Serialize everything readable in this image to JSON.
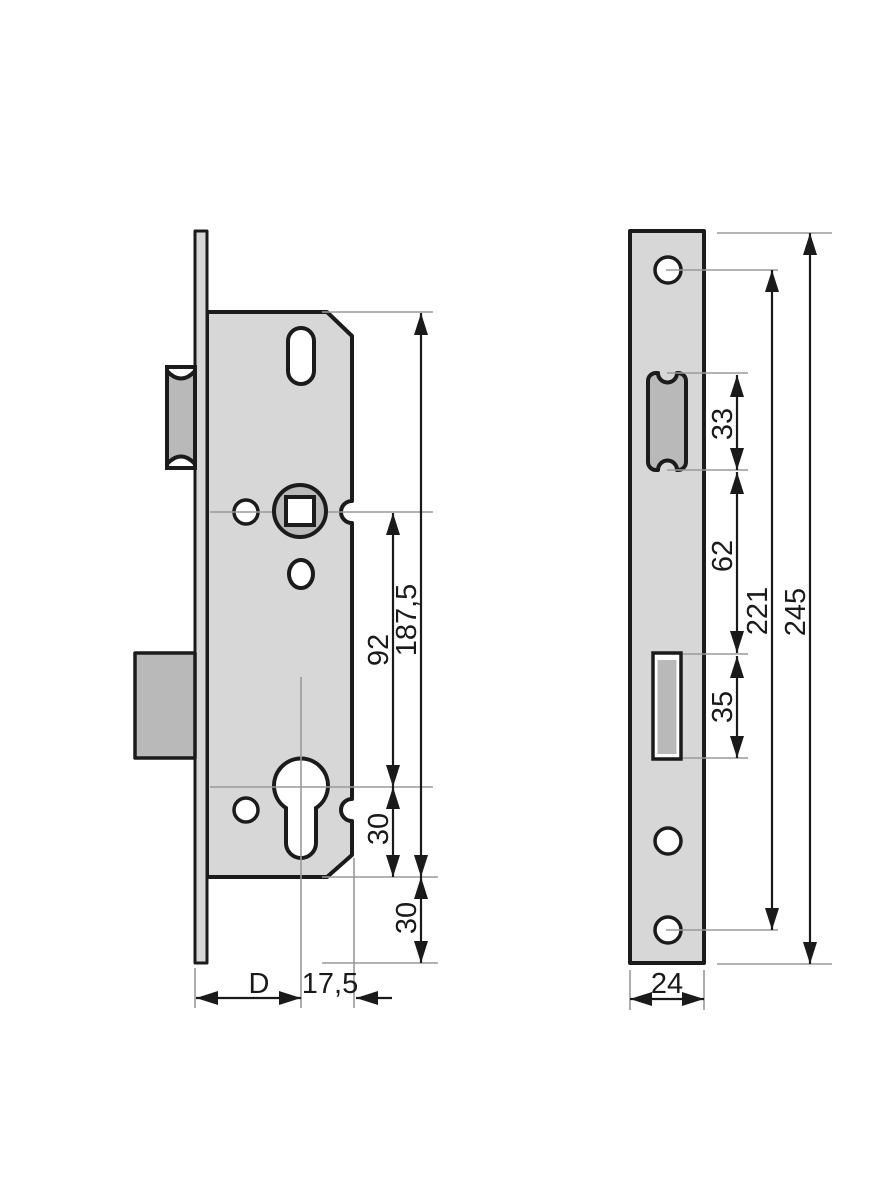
{
  "colors": {
    "background": "#ffffff",
    "part_fill": "#d7d7d7",
    "feature_fill": "#b9b9b9",
    "outline": "#1b1b1b",
    "guide": "#9a9a9a",
    "text": "#1a1a1a"
  },
  "dimensions": {
    "side_view": [
      {
        "id": "d187_5",
        "label": "187,5",
        "axis": "vertical"
      },
      {
        "id": "d92",
        "label": "92",
        "axis": "vertical"
      },
      {
        "id": "d30_upper",
        "label": "30",
        "axis": "vertical"
      },
      {
        "id": "d30_lower",
        "label": "30",
        "axis": "vertical"
      },
      {
        "id": "dD",
        "label": "D",
        "axis": "horizontal"
      },
      {
        "id": "d17_5",
        "label": "17,5",
        "axis": "horizontal"
      }
    ],
    "front_view": [
      {
        "id": "d33",
        "label": "33",
        "axis": "vertical"
      },
      {
        "id": "d62",
        "label": "62",
        "axis": "vertical"
      },
      {
        "id": "d35",
        "label": "35",
        "axis": "vertical"
      },
      {
        "id": "d221",
        "label": "221",
        "axis": "vertical"
      },
      {
        "id": "d245",
        "label": "245",
        "axis": "vertical"
      },
      {
        "id": "d24",
        "label": "24",
        "axis": "horizontal"
      }
    ]
  }
}
